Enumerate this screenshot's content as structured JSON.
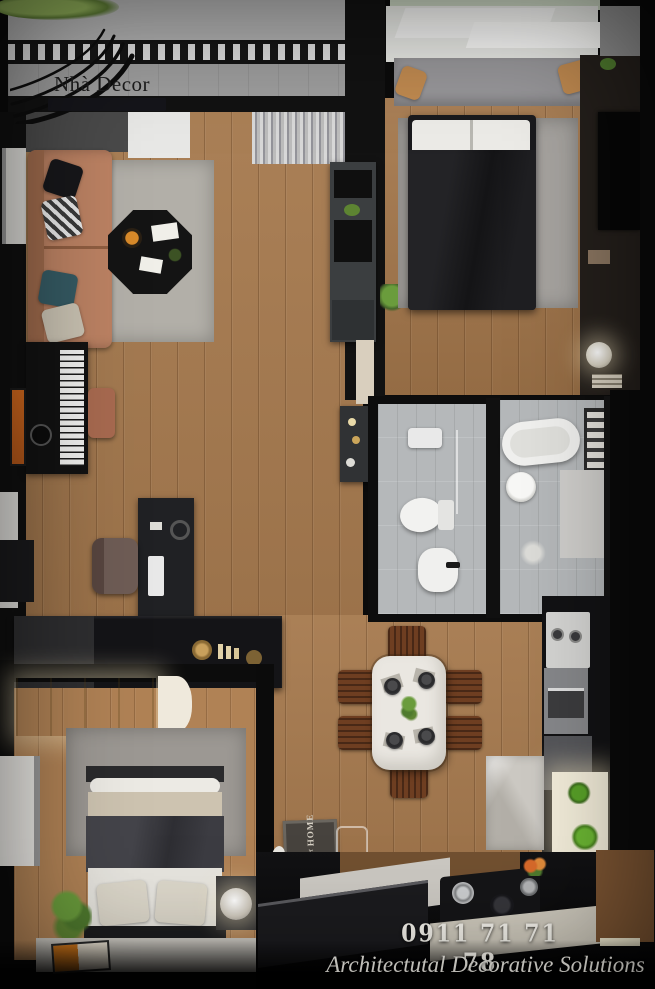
{
  "brand": {
    "name": "Nhà Decor"
  },
  "footer": {
    "phone": "0911 71 71 78",
    "tagline": "Architectutal Decorative Solutions"
  },
  "doormat": {
    "word_top": "HOME",
    "word_middle": "sweet",
    "word_bottom": "HOME"
  },
  "colors": {
    "background_black": "#0b0b0b",
    "wood_floor": "#a5784c",
    "wood_floor_warm": "#b08255",
    "balcony_gray": "#a9a9a9",
    "bathroom_tile": "#b5b8ba",
    "rug_gray": "#b2afa8",
    "sofa_tan": "#bc8263",
    "bed_dark": "#1a1a1d",
    "marble_white": "#eae7e1",
    "chair_wood": "#6e3e21",
    "accent_orange": "#dd7d1b",
    "plant_green": "#5d8432",
    "text_white": "#f2f0e9"
  }
}
